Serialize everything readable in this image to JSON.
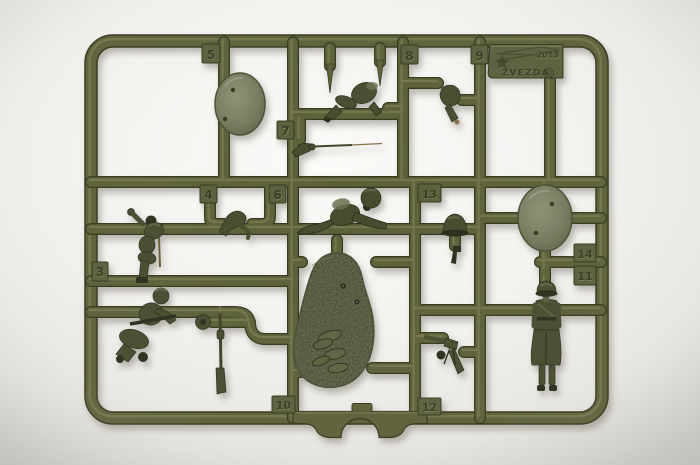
{
  "photo": {
    "subject": "olive-green injection-molded plastic model sprue with toy-soldier figure parts photographed on a white background"
  },
  "sprue": {
    "brand": "ZVEZDA",
    "year": "2013",
    "copyright_symbol": "©",
    "part_numbers": [
      "3",
      "4",
      "5",
      "6",
      "7",
      "8",
      "9",
      "10",
      "11",
      "12",
      "13",
      "14"
    ],
    "parts": [
      "molding-frame",
      "round-base-small-left",
      "round-base-small-right",
      "terrain-base-textured",
      "prone-rifleman",
      "running-legs",
      "rifle-with-bayonet",
      "kneeling-soldier-with-backpack",
      "bent-arms-pair",
      "bent-arm",
      "helmet",
      "pistol",
      "seated-machine-gunner",
      "ammo-drum",
      "upright-rifle",
      "machine-gun",
      "standing-soldier-greatcoat",
      "zvezda-logo-plate"
    ],
    "colors": {
      "background": "#f2f1ee",
      "plastic_mid": "#5c6039",
      "plastic_light": "#878a5f",
      "plastic_dark": "#34371f",
      "figure": "#474b2e",
      "figure_light": "#6d7150",
      "figure_dark": "#2b2e1c",
      "base_smooth": "#7c8066",
      "base_textured": "#3f432a",
      "metal_tan": "#8a7345",
      "tab_pad": "#5a5e3d",
      "digit": "#383b24",
      "digit_emboss": "#7d8156"
    }
  }
}
